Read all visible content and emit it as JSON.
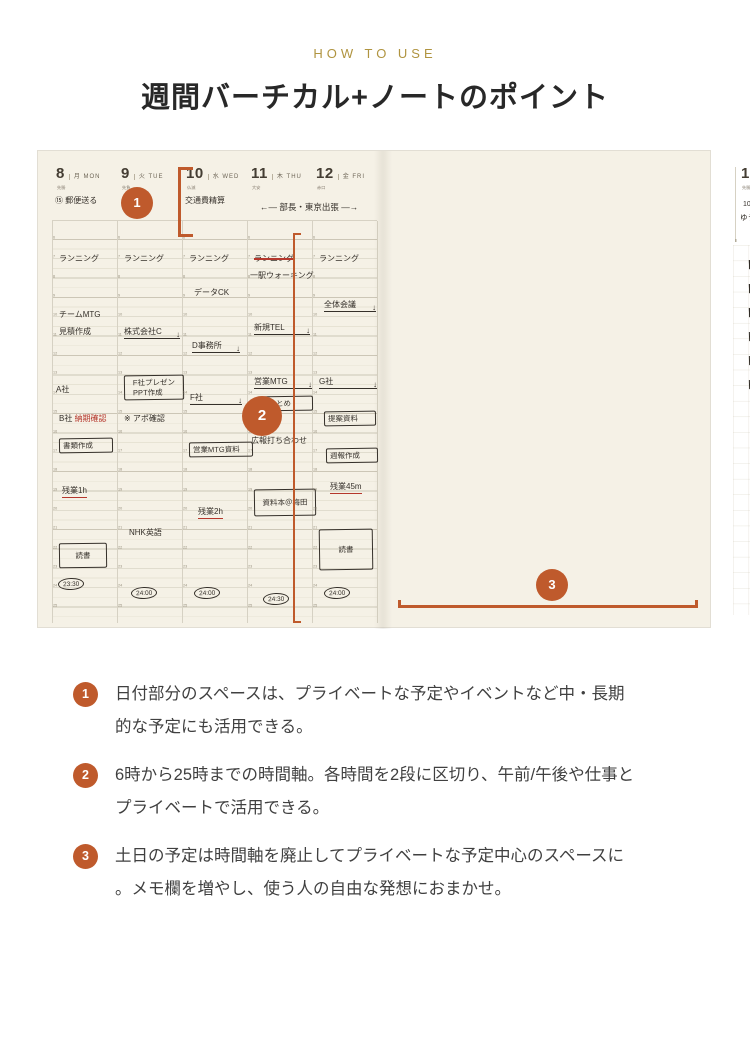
{
  "page": {
    "eyebrow": "HOW TO USE",
    "title": "週間バーチカル+ノートのポイント",
    "accent_color": "#bf5a2c",
    "eyebrow_color": "#b09440"
  },
  "callouts": {
    "c1": "1",
    "c2": "2",
    "c3": "3"
  },
  "planner": {
    "left_page": {
      "hours": {
        "start": 6,
        "end": 25
      },
      "span_note": "←— 部長・東京出張 —→",
      "days": [
        {
          "num": "8",
          "wd": "月 MON",
          "rokuyo": "先勝",
          "note": "⑮ 郵便送る",
          "entries": [
            {
              "h": 6.6,
              "style": "plain",
              "text": "ランニング"
            },
            {
              "h": 9.5,
              "style": "plain",
              "text": "チームMTG"
            },
            {
              "h": 10.4,
              "style": "plain",
              "text": "見積作成"
            },
            {
              "h": 13.4,
              "style": "plain",
              "text": "A社",
              "x": 4
            },
            {
              "h": 14.9,
              "style": "redmix",
              "text": "B社 ",
              "red": "納期確認"
            },
            {
              "h": 16.2,
              "style": "box",
              "text": "書類作成",
              "w": 46
            },
            {
              "h": 18.6,
              "style": "redunder",
              "text": "残業1h",
              "x": 10
            },
            {
              "h": 21.6,
              "style": "box",
              "text": "読書",
              "dur": 1.4,
              "w": 40
            },
            {
              "h": 23.4,
              "style": "oval",
              "text": "23:30",
              "x": 6
            }
          ]
        },
        {
          "num": "9",
          "wd": "火 TUE",
          "rokuyo": "先負",
          "note": "",
          "entries": [
            {
              "h": 6.6,
              "style": "plain",
              "text": "ランニング"
            },
            {
              "h": 10.4,
              "style": "task",
              "text": "株式会社C",
              "w": 56
            },
            {
              "h": 12.9,
              "style": "box",
              "text": "F社プレゼン\nPPT作成",
              "dur": 1.4,
              "w": 52
            },
            {
              "h": 14.9,
              "style": "plain",
              "text": "※ アポ確認"
            },
            {
              "h": 20.8,
              "style": "plain",
              "text": "NHK英語",
              "x": 12
            },
            {
              "h": 23.9,
              "style": "oval",
              "text": "24:00",
              "x": 14
            }
          ]
        },
        {
          "num": "10",
          "wd": "水 WED",
          "rokuyo": "仏滅",
          "note": "交通費精算",
          "entries": [
            {
              "h": 6.6,
              "style": "plain",
              "text": "ランニング"
            },
            {
              "h": 8.4,
              "style": "plain",
              "text": "データCK",
              "x": 12
            },
            {
              "h": 11.1,
              "style": "task",
              "text": "D事務所",
              "x": 10,
              "w": 48
            },
            {
              "h": 13.8,
              "style": "task",
              "text": "F社",
              "x": 8,
              "w": 52
            },
            {
              "h": 16.4,
              "style": "box",
              "text": "営業MTG資料",
              "w": 56
            },
            {
              "h": 19.7,
              "style": "redunder",
              "text": "残業2h",
              "x": 16
            },
            {
              "h": 23.9,
              "style": "oval",
              "text": "24:00",
              "x": 12
            }
          ]
        },
        {
          "num": "11",
          "wd": "木 THU",
          "rokuyo": "大安",
          "note": "",
          "entries": [
            {
              "h": 6.6,
              "style": "strike",
              "text": "ランニング"
            },
            {
              "h": 7.5,
              "style": "plain",
              "text": "一駅ウォーキング",
              "x": 3
            },
            {
              "h": 10.2,
              "style": "task",
              "text": "新規TEL",
              "w": 56
            },
            {
              "h": 13.0,
              "style": "task",
              "text": "営業MTG",
              "w": 58
            },
            {
              "h": 14.0,
              "style": "box",
              "text": "…まとめ",
              "x": 10,
              "w": 48
            },
            {
              "h": 16.0,
              "style": "plain",
              "text": "広報打ち合わせ",
              "x": 4
            },
            {
              "h": 18.8,
              "style": "box",
              "text": "資料本＠梅田",
              "dur": 1.5,
              "w": 54
            },
            {
              "h": 24.2,
              "style": "oval",
              "text": "24:30",
              "x": 16
            }
          ]
        },
        {
          "num": "12",
          "wd": "金 FRI",
          "rokuyo": "赤口",
          "note": "",
          "entries": [
            {
              "h": 6.6,
              "style": "plain",
              "text": "ランニング"
            },
            {
              "h": 9.0,
              "style": "task",
              "text": "全体会議",
              "x": 12,
              "w": 52
            },
            {
              "h": 13.0,
              "style": "task",
              "text": "G社",
              "w": 58
            },
            {
              "h": 14.8,
              "style": "box",
              "text": "提案資料",
              "x": 12,
              "w": 44
            },
            {
              "h": 16.7,
              "style": "box",
              "text": "週報作成",
              "x": 14,
              "w": 44
            },
            {
              "h": 18.4,
              "style": "redunder",
              "text": "残業45m",
              "x": 18
            },
            {
              "h": 20.9,
              "style": "box",
              "text": "読書",
              "dur": 2.2,
              "w": 46
            },
            {
              "h": 23.9,
              "style": "oval",
              "text": "24:00",
              "x": 12
            }
          ]
        }
      ]
    },
    "right_page": {
      "sat": {
        "num": "13",
        "wd": "土 SAT",
        "rokuyo": "先勝",
        "notes": [
          "10:40",
          "ゆうや土曜参観"
        ]
      },
      "sun": {
        "num": "14",
        "wd": "日 SUN",
        "rokuyo": "友引",
        "note": "公園"
      },
      "week_label_num": "14",
      "week_label_rest": " WEEK / 53",
      "month_block": {
        "num": "04",
        "name": "APRIL",
        "year": "2024｜令和6年"
      },
      "minicals": [
        {
          "label": "04",
          "dow": "月火水木金土日",
          "highlight_week": 1,
          "may": false,
          "weeks": [
            [
              "1",
              "2",
              "3",
              "4",
              "5",
              "6",
              "7"
            ],
            [
              "8",
              "9",
              "10",
              "11",
              "12",
              "13",
              "14"
            ],
            [
              "15",
              "16",
              "17",
              "18",
              "19",
              "20",
              "21"
            ],
            [
              "22",
              "23",
              "24",
              "25",
              "26",
              "27",
              "28"
            ],
            [
              "29",
              "30",
              "",
              "",
              "",
              "",
              ""
            ]
          ]
        },
        {
          "label": "05",
          "dow": "月火水木金土日",
          "highlight_week": -1,
          "may": true,
          "weeks": [
            [
              "",
              "",
              "1",
              "2",
              "3",
              "4",
              "5"
            ],
            [
              "6",
              "7",
              "8",
              "9",
              "10",
              "11",
              "12"
            ],
            [
              "13",
              "14",
              "15",
              "16",
              "17",
              "18",
              "19"
            ],
            [
              "20",
              "21",
              "22",
              "23",
              "24",
              "25",
              "26"
            ],
            [
              "27",
              "28",
              "29",
              "30",
              "31",
              "",
              ""
            ]
          ]
        }
      ],
      "checklist": [
        {
          "checked": true,
          "text": "見積作成"
        },
        {
          "checked": true,
          "text": "C社：会社概要確認"
        },
        {
          "checked": true,
          "text": "広報打ち合わせ資料、予算案"
        },
        {
          "checked": false,
          "text": "新規顧客リストまとめ"
        },
        {
          "checked": false,
          "text": "F社：プレゼン資料"
        },
        {
          "checked": false,
          "text": "提案資料案 → 課長へ"
        }
      ],
      "sketch_caption": "分布図を追加する",
      "section1": {
        "title": "秋の商談会について",
        "bullets": [
          "動向確認",
          "WEB商談会への切り替え?",
          "第2回開発部MTG → 4/18",
          "各社調整 確認メール",
          "発注〆、工場確認",
          "中国工場"
        ]
      },
      "section2": {
        "title": "今週の読書",
        "time": "3h30m",
        "bullets": [
          {
            "bullet": true,
            "text": "7つの習慣 ",
            "red": "4/10 読了!"
          },
          {
            "bullet": true,
            "text": "ストーリーとしての競争戦略",
            "red": ""
          },
          {
            "bullet": false,
            "text": "週末に少しまとまって読めた",
            "red": ""
          }
        ]
      },
      "tab": "04 APR"
    }
  },
  "notes": [
    {
      "num": "1",
      "lines": [
        "日付部分のスペースは、プライベートな予定やイベントなど中・長期",
        "的な予定にも活用できる。"
      ]
    },
    {
      "num": "2",
      "lines": [
        "6時から25時までの時間軸。各時間を2段に区切り、午前/午後や仕事と",
        "プライベートで活用できる。"
      ]
    },
    {
      "num": "3",
      "lines": [
        "土日の予定は時間軸を廃止してプライベートな予定中心のスペースに",
        "。メモ欄を増やし、使う人の自由な発想におまかせ。"
      ]
    }
  ]
}
